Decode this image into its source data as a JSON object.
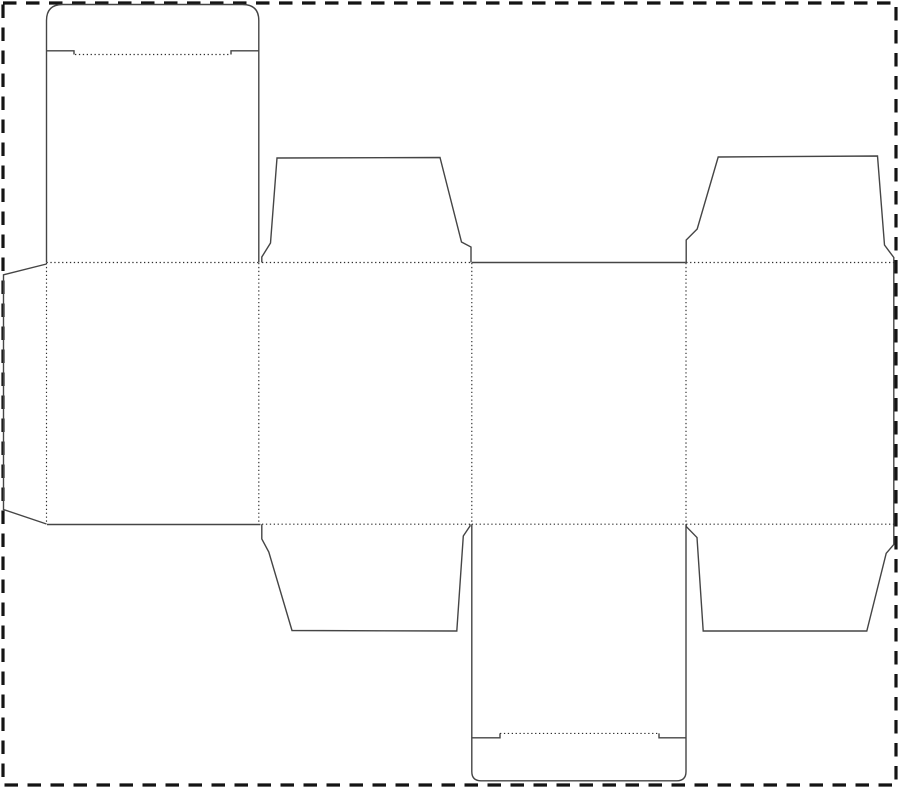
{
  "canvas": {
    "width": 900,
    "height": 788,
    "background": "#ffffff"
  },
  "border": {
    "name": "sheet-boundary-dashed-border",
    "x": 3,
    "y": 3,
    "width": 893,
    "height": 782,
    "color": "#141414",
    "stroke_width": 3.2,
    "dash": "13.5 9.5"
  },
  "dieline": {
    "cut_style": {
      "color": "#454545",
      "width": 1.4
    },
    "fold_style": {
      "color": "#2e2e2e",
      "width": 1.15,
      "dash": "1.3 2.6"
    },
    "cut_paths": [
      {
        "name": "top-lid-and-tuck-flap-outline",
        "d": "M 46.5 262.5 L 46.5 20.5 Q 46.5 4.5 62.5 4.5 L 242.5 4.5 Q 258.8 4.5 258.8 20.5 L 258.8 262.5"
      },
      {
        "name": "top-tuck-shoulder-left-cut",
        "d": "M 46.5 50.8 L 74 50.8 L 74 54.5"
      },
      {
        "name": "top-tuck-shoulder-right-cut",
        "d": "M 258.8 50.8 L 231 50.8 L 231 54.5"
      },
      {
        "name": "glue-flap-outline",
        "d": "M 46.5 264 L 3.5 274.8 L 3.5 509.5 L 46.5 524"
      },
      {
        "name": "panel-1-bottom-edge-cut",
        "d": "M 47 524.5 L 260.5 524.5"
      },
      {
        "name": "top-dust-flap-left-outline",
        "d": "M 261.8 262.5 L 261.8 257 L 270.5 243 L 277 158 L 440 157.5 L 461.5 242 L 471 247 L 471 262.5"
      },
      {
        "name": "panel-3-top-edge-cut",
        "d": "M 471.8 262.5 L 685.8 262.5"
      },
      {
        "name": "top-dust-flap-right-and-panel-4-side-outline",
        "d": "M 686.2 262.5 L 686.2 240 L 697.2 229 L 718.2 157 L 877.5 156 L 884.5 245 L 893.8 257.5 L 893.8 544.5 L 886.2 553.3 L 866.8 631 L 703.2 631 L 697 537.5 L 686.2 526.5 L 686.2 524.2"
      },
      {
        "name": "bottom-dust-flap-left-outline",
        "d": "M 261.8 524.2 L 261.8 539 L 268.8 552 L 292 630.5 L 456.8 631 L 463.3 536 L 470 526 L 470 524.2"
      },
      {
        "name": "bottom-tuck-panel-and-flap-outline",
        "d": "M 471.8 524.2 L 471.8 771.5 Q 471.8 780.8 481 780.8 L 676.8 780.8 Q 686 780.8 686 771.5 L 686 524.2"
      },
      {
        "name": "bottom-tuck-shoulder-left-cut",
        "d": "M 471.8 737.8 L 500 737.8 L 500 733.4"
      },
      {
        "name": "bottom-tuck-shoulder-right-cut",
        "d": "M 686 737.8 L 659 737.8 L 659 733.4"
      }
    ],
    "fold_lines": [
      {
        "name": "fold-top-tuck-flap",
        "x1": 75,
        "y1": 54.5,
        "x2": 231,
        "y2": 54.5
      },
      {
        "name": "fold-lid-to-panel-1",
        "x1": 46.5,
        "y1": 262.5,
        "x2": 258.8,
        "y2": 262.5
      },
      {
        "name": "fold-top-dust-flap-left",
        "x1": 262,
        "y1": 262.5,
        "x2": 471,
        "y2": 262.5
      },
      {
        "name": "fold-top-dust-flap-right",
        "x1": 686.2,
        "y1": 262.5,
        "x2": 893.8,
        "y2": 262.5
      },
      {
        "name": "fold-glue-flap",
        "x1": 46.5,
        "y1": 263,
        "x2": 46.5,
        "y2": 523.5
      },
      {
        "name": "fold-panel-1-2",
        "x1": 258.8,
        "y1": 263,
        "x2": 258.8,
        "y2": 524
      },
      {
        "name": "fold-panel-2-3",
        "x1": 471.8,
        "y1": 263,
        "x2": 471.8,
        "y2": 524
      },
      {
        "name": "fold-panel-3-4",
        "x1": 686,
        "y1": 263,
        "x2": 686,
        "y2": 524
      },
      {
        "name": "fold-bottom-dust-flap-left",
        "x1": 262,
        "y1": 524.2,
        "x2": 470,
        "y2": 524.2
      },
      {
        "name": "fold-panel-3-to-bottom-tuck",
        "x1": 471.8,
        "y1": 524.2,
        "x2": 686,
        "y2": 524.2
      },
      {
        "name": "fold-bottom-dust-flap-right",
        "x1": 686.2,
        "y1": 524.2,
        "x2": 893.8,
        "y2": 524.2
      },
      {
        "name": "fold-bottom-tuck-flap",
        "x1": 500,
        "y1": 733.4,
        "x2": 659,
        "y2": 733.4
      }
    ]
  }
}
